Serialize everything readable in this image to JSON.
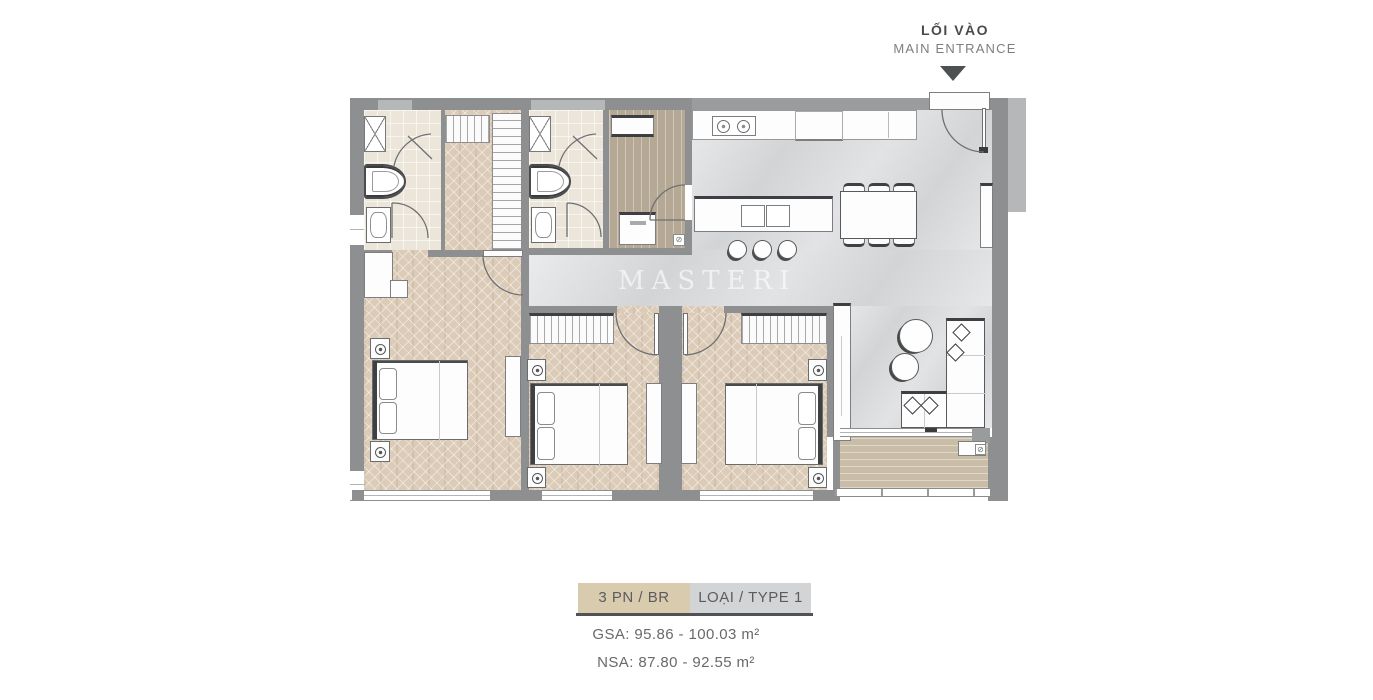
{
  "entrance": {
    "label_vi": "LỐI VÀO",
    "label_en": "MAIN ENTRANCE"
  },
  "watermark": {
    "text": "MASTERI"
  },
  "legend": {
    "badge_left": "3 PN / BR",
    "badge_right": "LOẠI / TYPE 1",
    "gsa": "GSA: 95.86 - 100.03 m²",
    "nsa": "NSA: 87.80 - 92.55 m²"
  },
  "icons": {
    "drain_glyph": "⊘"
  },
  "colors": {
    "wall": "#8e8f91",
    "wood_floor": "#dbcbb7",
    "marble_floor": "#d3d4d6",
    "bath_floor": "#ebe6d9",
    "utility_floor": "#b5a894",
    "balcony_floor": "#cabda7",
    "badge_tan": "#d9ccae",
    "badge_gray": "#d3d4d5",
    "entrance_arrow": "#4d5153"
  }
}
